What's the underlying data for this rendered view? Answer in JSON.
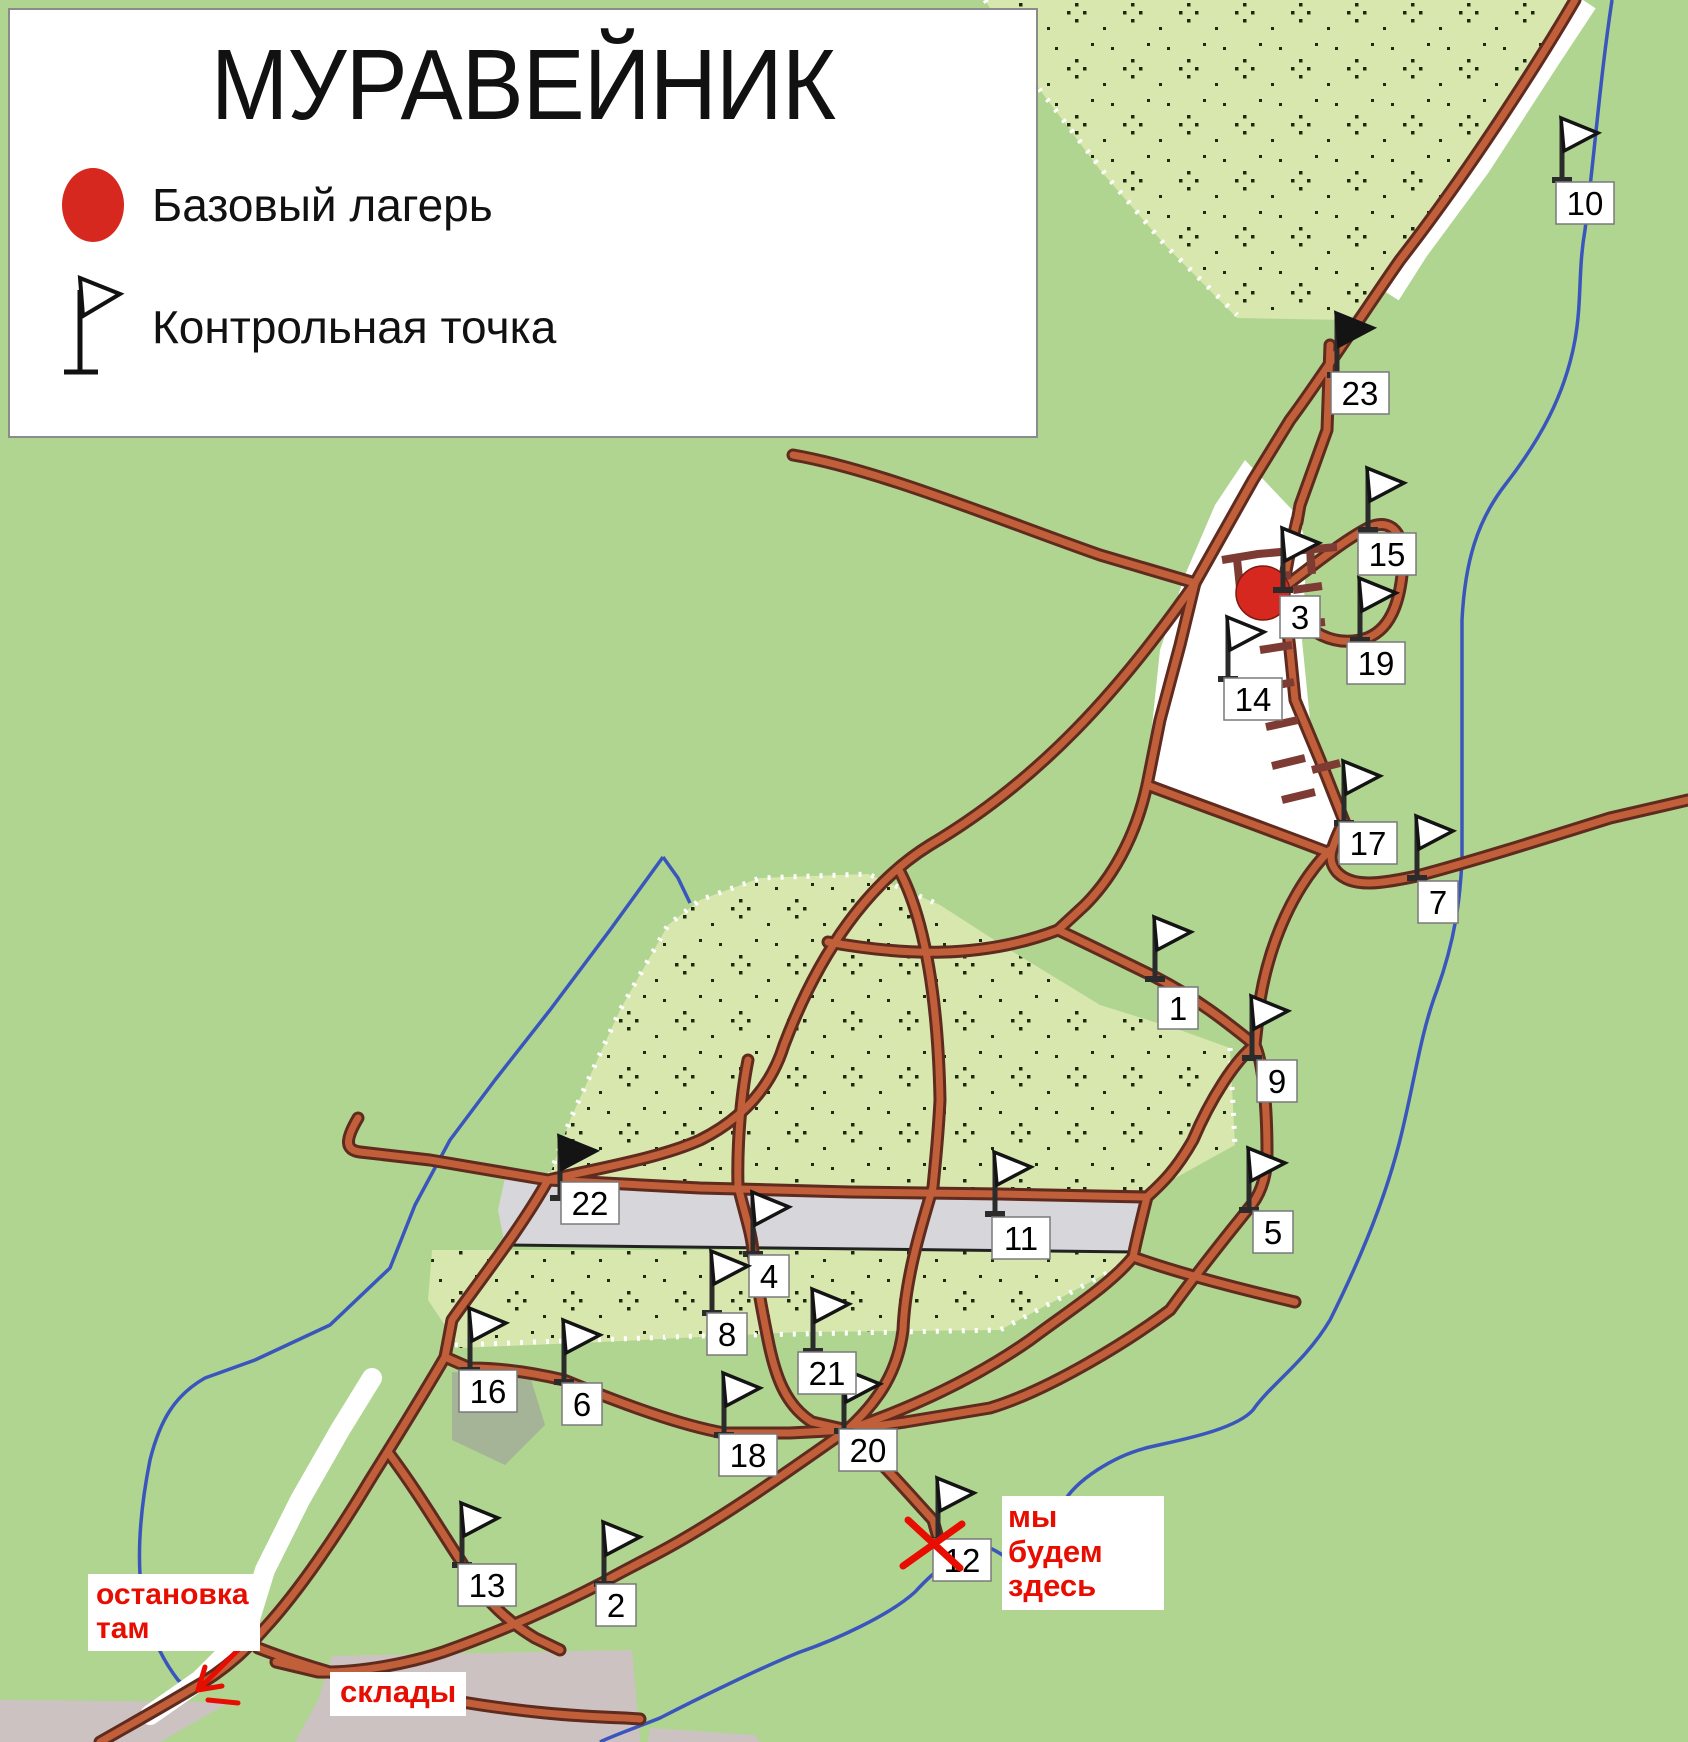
{
  "legend": {
    "title": "МУРАВЕЙНИК",
    "items": [
      {
        "icon": "base-camp-dot",
        "label": "Базовый лагерь"
      },
      {
        "icon": "control-point-flag",
        "label": "Контрольная точка"
      }
    ]
  },
  "annotations": {
    "we_will_be_here": "мы будем\nздесь",
    "bus_stop": "остановка\nтам",
    "warehouses": "склады"
  },
  "base_camp": {
    "x": 1263,
    "y": 593,
    "r": 27
  },
  "checkpoints": [
    {
      "num": "1",
      "flag": [
        1155,
        977
      ],
      "label": [
        1178,
        1008
      ],
      "dark": false
    },
    {
      "num": "2",
      "flag": [
        604,
        1582
      ],
      "label": [
        616,
        1605
      ],
      "dark": false
    },
    {
      "num": "3",
      "flag": [
        1283,
        588
      ],
      "label": [
        1300,
        617
      ],
      "dark": false
    },
    {
      "num": "4",
      "flag": [
        753,
        1252
      ],
      "label": [
        769,
        1276
      ],
      "dark": false
    },
    {
      "num": "5",
      "flag": [
        1249,
        1208
      ],
      "label": [
        1273,
        1232
      ],
      "dark": false
    },
    {
      "num": "6",
      "flag": [
        564,
        1380
      ],
      "label": [
        582,
        1404
      ],
      "dark": false
    },
    {
      "num": "7",
      "flag": [
        1417,
        876
      ],
      "label": [
        1438,
        902
      ],
      "dark": false
    },
    {
      "num": "8",
      "flag": [
        712,
        1311
      ],
      "label": [
        727,
        1334
      ],
      "dark": false
    },
    {
      "num": "9",
      "flag": [
        1252,
        1056
      ],
      "label": [
        1277,
        1081
      ],
      "dark": false
    },
    {
      "num": "10",
      "flag": [
        1562,
        178
      ],
      "label": [
        1585,
        203
      ],
      "dark": false
    },
    {
      "num": "11",
      "flag": [
        995,
        1212
      ],
      "label": [
        1021,
        1238
      ],
      "dark": false
    },
    {
      "num": "12",
      "flag": [
        938,
        1538
      ],
      "label": [
        962,
        1560
      ],
      "dark": false
    },
    {
      "num": "13",
      "flag": [
        462,
        1563
      ],
      "label": [
        487,
        1585
      ],
      "dark": false
    },
    {
      "num": "14",
      "flag": [
        1228,
        677
      ],
      "label": [
        1253,
        699
      ],
      "dark": false
    },
    {
      "num": "15",
      "flag": [
        1368,
        528
      ],
      "label": [
        1387,
        554
      ],
      "dark": false
    },
    {
      "num": "16",
      "flag": [
        470,
        1368
      ],
      "label": [
        488,
        1391
      ],
      "dark": false
    },
    {
      "num": "17",
      "flag": [
        1344,
        821
      ],
      "label": [
        1368,
        843
      ],
      "dark": false
    },
    {
      "num": "18",
      "flag": [
        724,
        1433
      ],
      "label": [
        748,
        1455
      ],
      "dark": false
    },
    {
      "num": "19",
      "flag": [
        1360,
        638
      ],
      "label": [
        1376,
        663
      ],
      "dark": false
    },
    {
      "num": "20",
      "flag": [
        844,
        1429
      ],
      "label": [
        868,
        1450
      ],
      "dark": false
    },
    {
      "num": "21",
      "flag": [
        813,
        1349
      ],
      "label": [
        827,
        1373
      ],
      "dark": false
    },
    {
      "num": "22",
      "flag": [
        560,
        1196
      ],
      "label": [
        590,
        1203
      ],
      "dark": true
    },
    {
      "num": "23",
      "flag": [
        1337,
        373
      ],
      "label": [
        1360,
        393
      ],
      "dark": true
    }
  ],
  "colors": {
    "background_green": "#afd591",
    "forest_fill": "#d8e7ae",
    "road_fill": "#c05f3a",
    "road_casing": "#5e2b1e",
    "comb_maroon": "#7d3b33",
    "river_blue": "#3a56bd",
    "field_gray": "#d7d7db",
    "town_gray": "#cdc2c2",
    "camp_red": "#d6281e",
    "note_red": "#e70d00"
  }
}
